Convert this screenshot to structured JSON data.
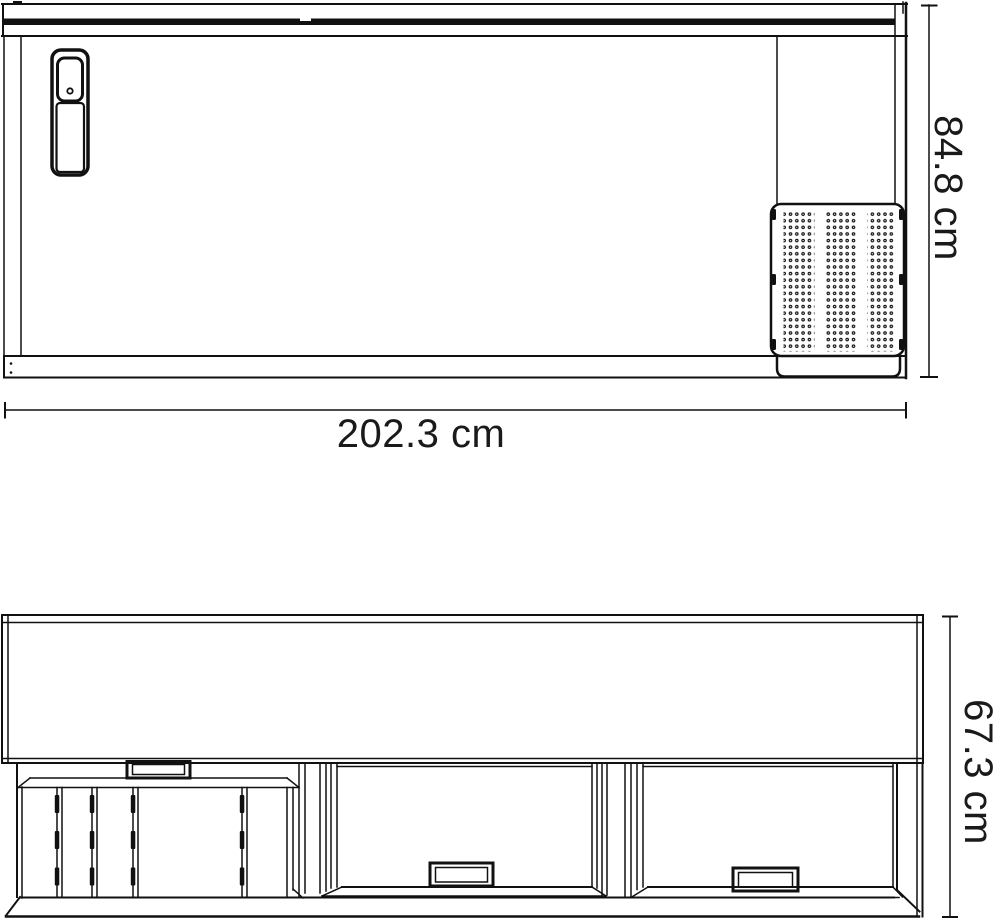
{
  "diagram": {
    "type": "technical-drawing",
    "line_color": "#111111",
    "background_color": "#ffffff",
    "unit": "cm",
    "views": {
      "front_elevation": {
        "name": "front-elevation",
        "width_dimension": {
          "label": "202.3 cm",
          "value": 202.3,
          "unit": "cm",
          "orientation": "horizontal"
        },
        "height_dimension": {
          "label": "84.8 cm",
          "value": 84.8,
          "unit": "cm",
          "orientation": "vertical"
        }
      },
      "plan_view": {
        "name": "plan-view",
        "depth_dimension": {
          "label": "67.3 cm",
          "value": 67.3,
          "unit": "cm",
          "orientation": "vertical"
        }
      }
    }
  }
}
